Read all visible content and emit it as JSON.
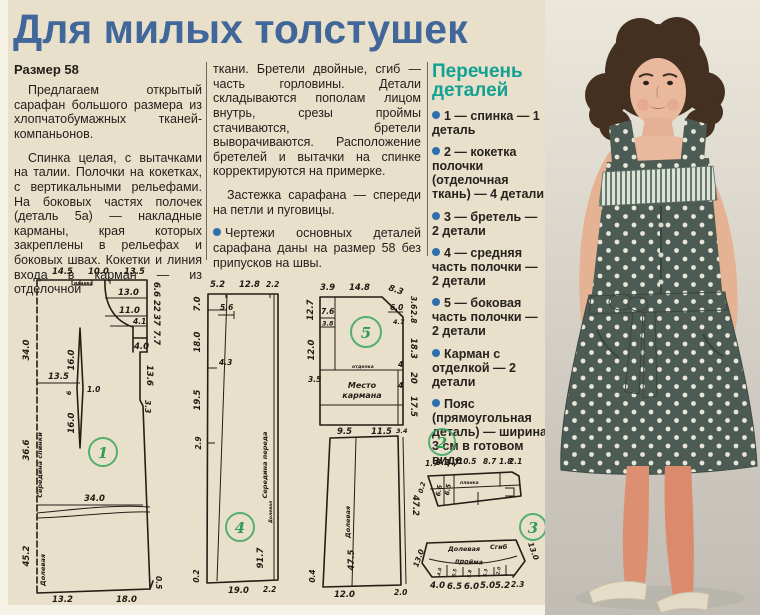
{
  "page": {
    "title": "Для милых толстушек"
  },
  "colors": {
    "paper": "#e9e0cb",
    "title_blue": "#41679a",
    "parts_title_teal": "#12a193",
    "bullet_blue": "#2e6fae",
    "circle_green": "#3aa55f",
    "dress_fabric": "#4c5b53",
    "dress_dots": "#e9e6d8",
    "tights": "#dd8f71"
  },
  "article": {
    "size_label": "Размер 58",
    "col1_p1": "Предлагаем открытый сарафан большого размера из хлопчатобумажных тканей-компаньонов.",
    "col1_p2": "Спинка целая, с вытачками на талии. Полочки на кокетках, с вертикальными рельефами. На боковых частях полочек (деталь 5а) — накладные карманы, края которых закреплены в рельефах и боковых швах. Кокетки и линия входа в карман — из отделочной",
    "col2_p1": "ткани. Бретели двойные, сгиб — часть горловины. Детали складываются пополам лицом внутрь, срезы проймы стачиваются, бретели выворачиваются. Расположение бретелей и вытачки на спинке корректируются на примерке.",
    "col2_p2": "Застежка сарафана — спереди на петли и пуговицы.",
    "col2_p3": "Чертежи основных деталей сарафана даны на размер 58 без припусков на швы."
  },
  "parts_list": {
    "title": "Перечень деталей",
    "items": [
      "1 — спинка — 1 деталь",
      "2 — кокетка полочки (отделочная ткань) — 4 детали",
      "3 — бретель — 2 детали",
      "4 — средняя часть полочки — 2 детали",
      "5 — боковая часть полочки — 2 детали",
      "Карман с отделкой — 2 детали",
      "Пояс (прямоугольная деталь) — ширина 3 см в готовом виде"
    ]
  },
  "diagrams": {
    "p1": {
      "num": "1",
      "top": [
        "14.5",
        "10.0",
        "13.5"
      ],
      "tab": "планка",
      "boxes": [
        "13.0",
        "11.0",
        "4.1",
        "4.0",
        "13.6",
        "3.3"
      ],
      "rightside": [
        "6.6",
        "22",
        "37",
        "7.7"
      ],
      "left": [
        "34.0",
        "36.6",
        "45.2"
      ],
      "leftlabel": "Середина спинки",
      "grain": "Долевая",
      "dart": [
        "16.0",
        "6",
        "1.0",
        "16.0"
      ],
      "waist": "13.5",
      "width": "34.0",
      "bottom": [
        "13.2",
        "18.0"
      ],
      "corner": "0.5"
    },
    "p4": {
      "num": "4",
      "top": [
        "5.2",
        "12.8",
        "2.2"
      ],
      "left": [
        "7.0",
        "18.0",
        "19.5",
        "2.9",
        "0.2"
      ],
      "inner": [
        "5.6",
        "4.3"
      ],
      "length": "91.7",
      "centerlabel": "Середина переда",
      "grain": "Долевая",
      "bottom": [
        "19.0",
        "2.2"
      ]
    },
    "p5": {
      "num": "5",
      "top": [
        "3.9",
        "14.8",
        "8.3"
      ],
      "topright": [
        "3.6",
        "2.8"
      ],
      "rightboxes": [
        "6.0",
        "4.7"
      ],
      "right": [
        "18.3",
        "4",
        "20",
        "4",
        "17.5"
      ],
      "left": [
        "12.7",
        "7.6",
        "3.8",
        "12.0",
        "3.5"
      ],
      "pocket_line": "отделка",
      "pocket1": "Место",
      "pocket2": "кармана",
      "mid": [
        "9.5",
        "11.5",
        "3.4"
      ],
      "lowerleft": "0.4",
      "length": "47.5",
      "rightlen": "47.2",
      "grain": "Долевая",
      "bottom": [
        "12.0",
        "2.0"
      ]
    },
    "p2": {
      "num": "2",
      "top": [
        "1.7",
        "3.2",
        "3.7",
        "10.5",
        "8.7",
        "1.8",
        "2.1"
      ],
      "left": "0.2",
      "inner": [
        "6.6",
        "6.5"
      ],
      "tab": "планка"
    },
    "p3": {
      "num": "3",
      "sides": [
        "13.0",
        "13.0"
      ],
      "grain": "Долевая",
      "fold": "Сгиб",
      "armhole": "пройма",
      "inner": [
        "4.0",
        "5.5",
        "5.8",
        "5.3",
        "2.0"
      ],
      "bottom": [
        "4.0",
        "6.5",
        "6.0",
        "5.0",
        "5.2",
        "2.3"
      ]
    }
  }
}
